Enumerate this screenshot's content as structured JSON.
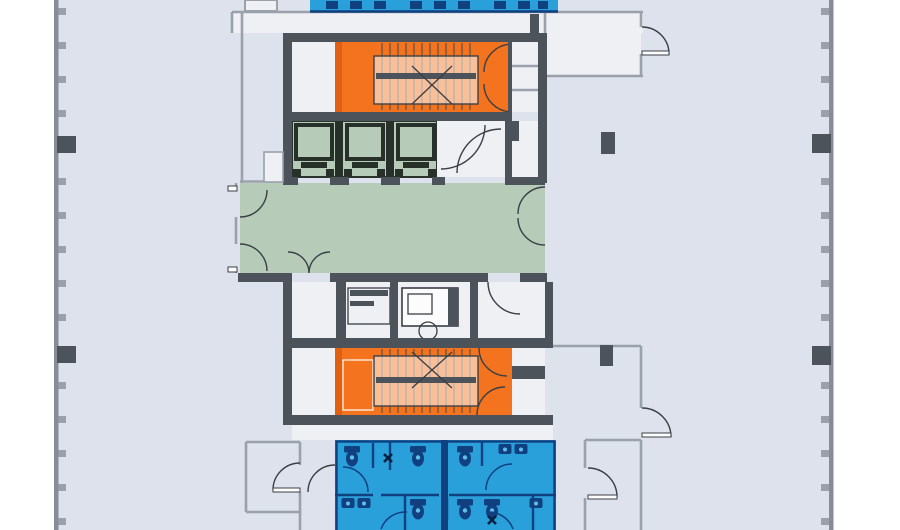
{
  "document": {
    "type": "architectural-floor-plan",
    "description": "Typical tower floor plate, cut off top and bottom; central service core flanked by open tenant space with curtain-wall mullions left and right",
    "text_labels": []
  },
  "palette": {
    "outside": "#ffffff",
    "floor": "#dde2ec",
    "room-floor": "#eef0f4",
    "wall-dark": "#4d535a",
    "wall-light": "#9aa1ab",
    "orange": "#f3731f",
    "orange-shade": "#e05f10",
    "green": "#b7ccb8",
    "green-dark": "#27312a",
    "blue": "#2aa0da",
    "blue-dark": "#10407f",
    "ink": "#3a3f45"
  },
  "zones": [
    {
      "id": "restrooms-north",
      "kind": "restrooms",
      "color_key": "blue",
      "note": "cut off at top edge"
    },
    {
      "id": "stairwell-north",
      "kind": "stairwell",
      "color_key": "orange"
    },
    {
      "id": "elevator-bank",
      "kind": "elevators",
      "color_key": "green",
      "shafts": 3
    },
    {
      "id": "elevator-lobby",
      "kind": "lobby",
      "color_key": "green",
      "doors": [
        "west-pair",
        "east-pair",
        "south-double"
      ]
    },
    {
      "id": "service-rooms",
      "kind": "service",
      "color_key": "room-floor"
    },
    {
      "id": "stairwell-south",
      "kind": "stairwell",
      "color_key": "orange"
    },
    {
      "id": "restrooms-south",
      "kind": "restrooms",
      "color_key": "blue",
      "note": "cut off at bottom edge"
    },
    {
      "id": "tenant-space-west",
      "kind": "open-floor",
      "color_key": "floor"
    },
    {
      "id": "tenant-space-east",
      "kind": "open-floor",
      "color_key": "floor"
    }
  ],
  "structure": {
    "exterior_wall_columns": 4,
    "interior_columns": 2,
    "mullion_spacing_px": 34
  }
}
